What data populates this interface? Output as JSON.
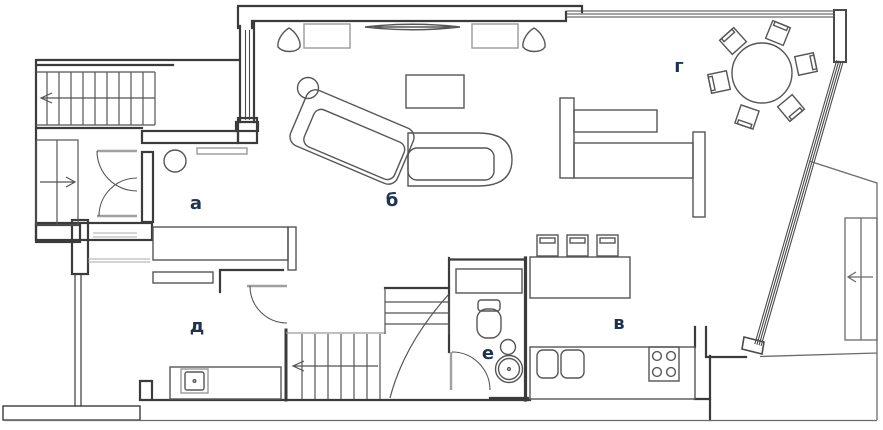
{
  "plan": {
    "type": "apartment-floor-plan",
    "rooms": [
      {
        "key": "room-a",
        "label": "а"
      },
      {
        "key": "room-b",
        "label": "б"
      },
      {
        "key": "room-v",
        "label": "в"
      },
      {
        "key": "room-g",
        "label": "г"
      },
      {
        "key": "room-d",
        "label": "д"
      },
      {
        "key": "room-e",
        "label": "е"
      }
    ],
    "colors": {
      "walls": "#3b3b3b",
      "furniture": "#565656",
      "light_gray": "#a0a0a0",
      "labels": "#1d3450",
      "background": "#ffffff"
    }
  }
}
